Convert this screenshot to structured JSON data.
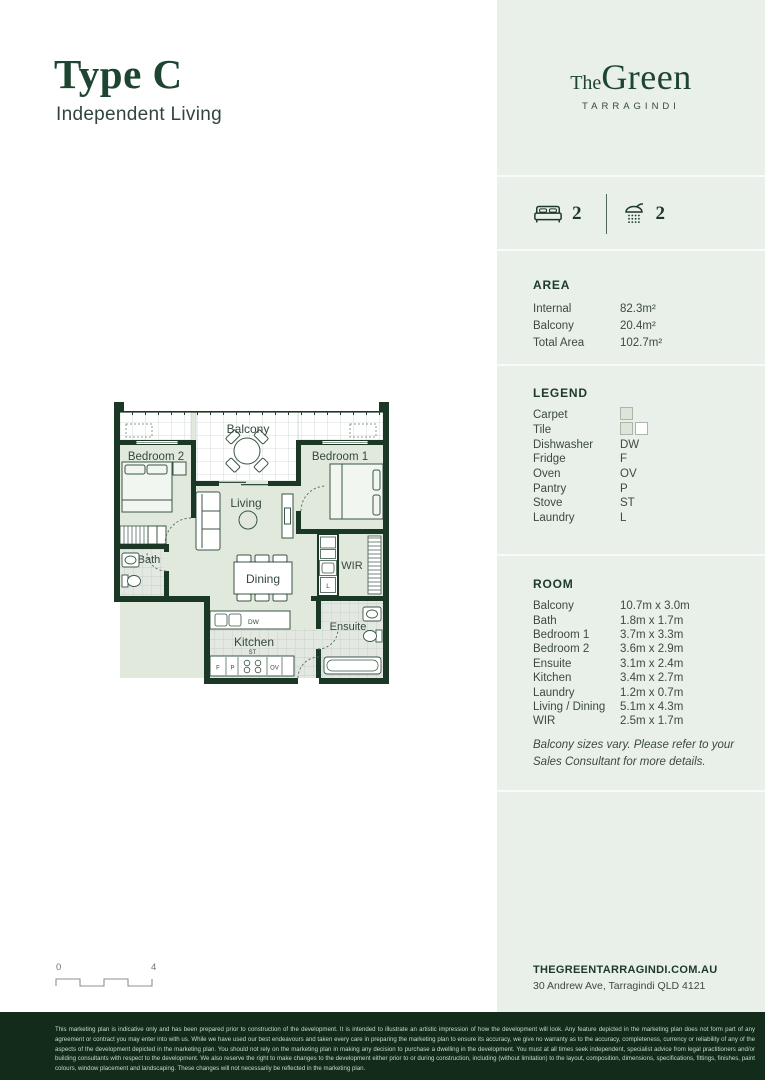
{
  "page": {
    "title": "Type C",
    "subtitle": "Independent Living"
  },
  "brand": {
    "the": "The",
    "green": "Green",
    "tagline": "TARRAGINDI"
  },
  "stats": {
    "beds": "2",
    "baths": "2"
  },
  "area": {
    "heading": "AREA",
    "rows": [
      {
        "label": "Internal",
        "value": "82.3m²"
      },
      {
        "label": "Balcony",
        "value": "20.4m²"
      },
      {
        "label": "Total Area",
        "value": "102.7m²"
      }
    ]
  },
  "legend": {
    "heading": "LEGEND",
    "rows": [
      {
        "label": "Carpet",
        "value": ""
      },
      {
        "label": "Tile",
        "value": ""
      },
      {
        "label": "Dishwasher",
        "value": "DW"
      },
      {
        "label": "Fridge",
        "value": "F"
      },
      {
        "label": "Oven",
        "value": "OV"
      },
      {
        "label": "Pantry",
        "value": "P"
      },
      {
        "label": "Stove",
        "value": "ST"
      },
      {
        "label": "Laundry",
        "value": "L"
      }
    ]
  },
  "room": {
    "heading": "ROOM",
    "rows": [
      {
        "label": "Balcony",
        "value": "10.7m x 3.0m"
      },
      {
        "label": "Bath",
        "value": "1.8m x 1.7m"
      },
      {
        "label": "Bedroom 1",
        "value": "3.7m x 3.3m"
      },
      {
        "label": "Bedroom 2",
        "value": "3.6m x 2.9m"
      },
      {
        "label": "Ensuite",
        "value": "3.1m x 2.4m"
      },
      {
        "label": "Kitchen",
        "value": "3.4m x 2.7m"
      },
      {
        "label": "Laundry",
        "value": "1.2m x 0.7m"
      },
      {
        "label": "Living / Dining",
        "value": "5.1m x 4.3m"
      },
      {
        "label": "WIR",
        "value": "2.5m x 1.7m"
      }
    ],
    "note": "Balcony sizes vary. Please refer to your Sales Consultant for more details."
  },
  "contact": {
    "website": "THEGREENTARRAGINDI.COM.AU",
    "address": "30 Andrew Ave, Tarragindi QLD 4121"
  },
  "scalebar": {
    "start": "0",
    "end": "4"
  },
  "plan": {
    "labels": {
      "balcony": "Balcony",
      "bedroom2": "Bedroom 2",
      "bedroom1": "Bedroom 1",
      "living": "Living",
      "dining": "Dining",
      "bath": "Bath",
      "wir": "WIR",
      "ensuite": "Ensuite",
      "kitchen": "Kitchen",
      "laundry": "L",
      "dishwasher": "DW",
      "stove": "ST",
      "fridge": "F",
      "pantry": "P",
      "oven": "OV"
    }
  },
  "colors": {
    "accent_dark_green": "#1d4531",
    "wall_green": "#1b3826",
    "sidebar_bg": "#e9efe9",
    "footer_bg": "#132b1a",
    "carpet": "#e0e9dc"
  },
  "disclaimer": "This marketing plan is indicative only and has been prepared prior to construction of the development. It is intended to illustrate an artistic impression of how the development will look. Any feature depicted in the marketing plan does not form part of any agreement or contract you may enter into with us. While we have used our best endeavours and taken every care in preparing the marketing plan to ensure its accuracy, we give no warranty as to the accuracy, completeness, currency or reliability of any of the aspects of the development depicted in the marketing plan. You should not rely on the marketing plan in making any decision to purchase a dwelling in the development. You must at all times seek independent, specialist advice from legal practitioners and/or building consultants with respect to the development. We also reserve the right to make changes to the development either prior to or during construction, including (without limitation) to the layout, composition, dimensions, specifications, fittings, finishes, paint colours, window placement and landscaping. These changes will not necessarily be reflected in the marketing plan."
}
